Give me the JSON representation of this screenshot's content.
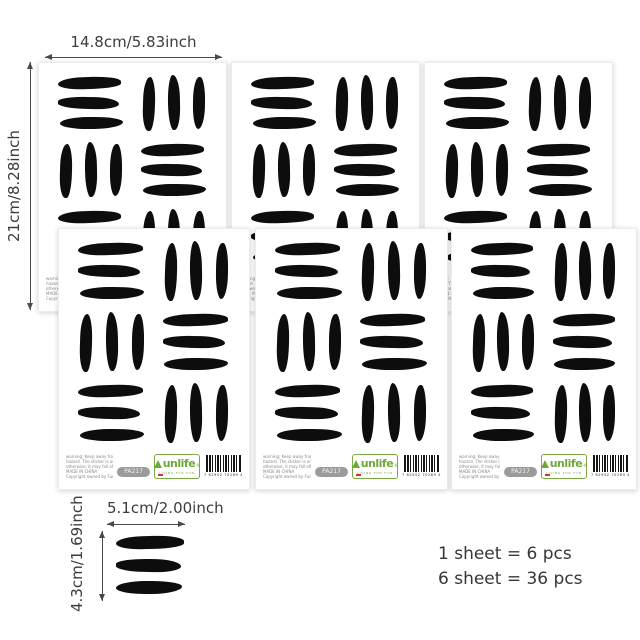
{
  "annotations": {
    "sheet_width": "14.8cm/5.83inch",
    "sheet_height": "21cm/8.28inch",
    "piece_width": "5.1cm/2.00inch",
    "piece_height": "4.3cm/1.69inch"
  },
  "info": {
    "line1": "1 sheet = 6 pcs",
    "line2": "6 sheet = 36 pcs"
  },
  "sheet": {
    "count": 6,
    "pattern": [
      [
        "h",
        "v"
      ],
      [
        "v",
        "h"
      ],
      [
        "h",
        "v"
      ]
    ],
    "strokes_per_group": 3,
    "footer": {
      "warning_lines": [
        "warning: Keep away from children under age of 3 due to choking",
        "hazard. The sticker is only allowed to apply on smooth surface,",
        "otherwise, it may fall off easily.",
        "MADE IN CHINA",
        "Copyright owned by Funlife"
      ],
      "badge": "PA217",
      "logo_text": "unlife",
      "registered": "®",
      "logo_tagline": "LIVING FOR FUN",
      "barcode_digits": "7 62952 70269 4"
    }
  },
  "colors": {
    "stroke_black": "#0d0d0d",
    "logo_green": "#6fa83c",
    "badge_gray": "#9b9b9b",
    "logo_red": "#cf3a28",
    "text_dark": "#3c3c3c"
  }
}
